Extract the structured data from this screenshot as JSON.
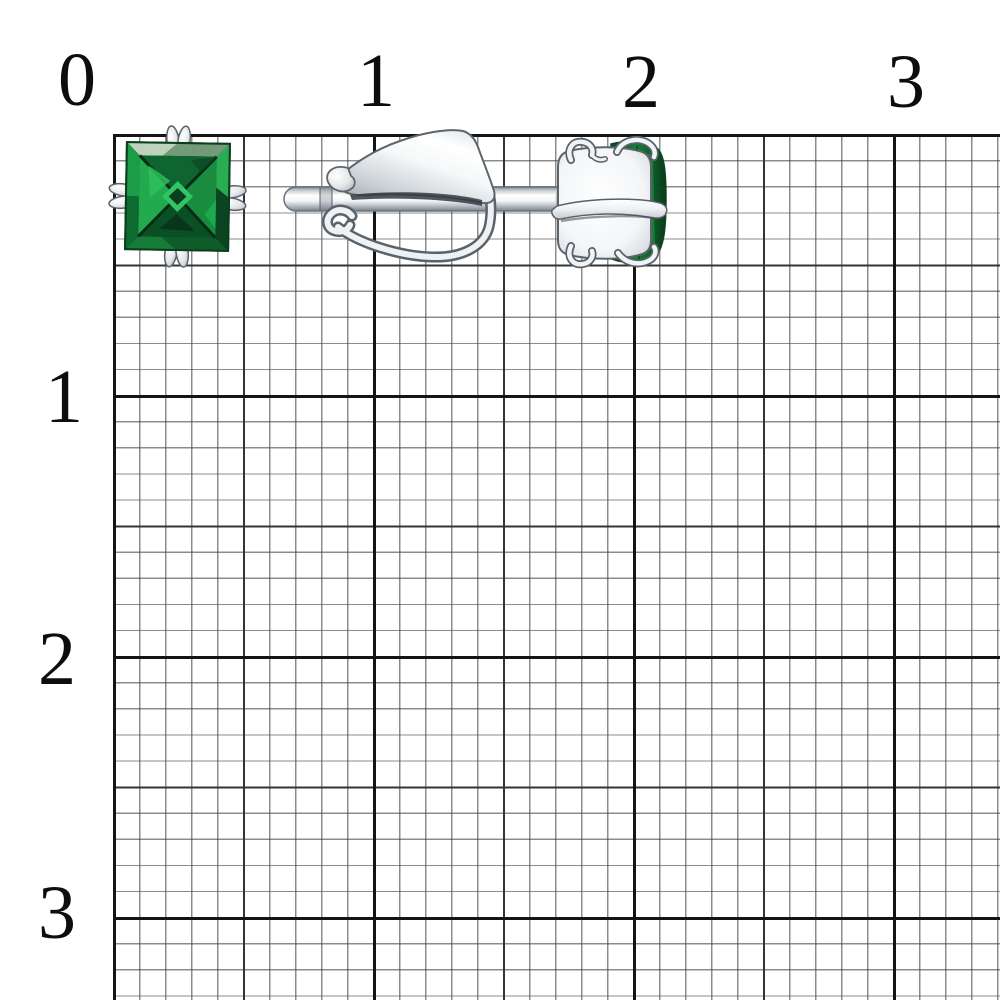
{
  "ruler": {
    "top_labels": [
      "0",
      "1",
      "2",
      "3"
    ],
    "left_labels": [
      "1",
      "2",
      "3"
    ]
  },
  "grid": {
    "paper_color": "#ffffff",
    "minor_line_color": "#5f5f5f",
    "medium_line_color": "#343434",
    "major_line_color": "#141414"
  },
  "earrings": {
    "stone_color_bright": "#2fc05e",
    "stone_color_mid": "#17863d",
    "stone_color_dark": "#0a4420",
    "metal_color_light": "#ffffff",
    "metal_color_mid": "#d9dee2",
    "metal_color_dark": "#5d656d"
  }
}
